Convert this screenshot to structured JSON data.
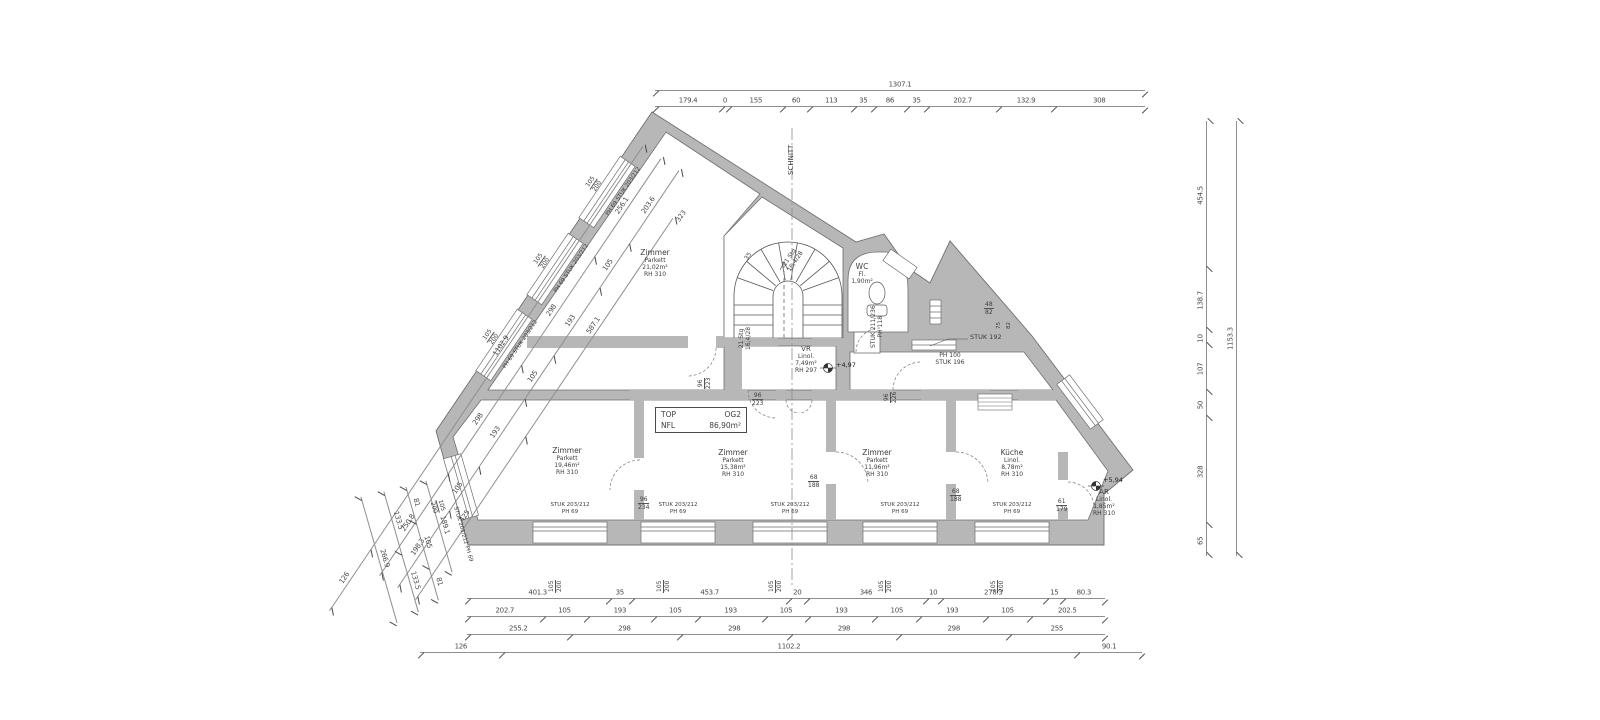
{
  "drawing": {
    "section_label": "SCHNITT",
    "title_box": {
      "l1a": "TOP",
      "l1b": "OG2",
      "l2a": "NFL",
      "l2b": "86,90m²"
    },
    "rooms": [
      {
        "id": "zimmer-top",
        "name": "Zimmer",
        "floor": "Parkett",
        "area": "21,02m²",
        "rh": "RH 310"
      },
      {
        "id": "zimmer-left",
        "name": "Zimmer",
        "floor": "Parkett",
        "area": "19,46m²",
        "rh": "RH 310"
      },
      {
        "id": "zimmer-mid",
        "name": "Zimmer",
        "floor": "Parkett",
        "area": "15,38m²",
        "rh": "RH 310"
      },
      {
        "id": "zimmer-right",
        "name": "Zimmer",
        "floor": "Parkett",
        "area": "11,96m²",
        "rh": "RH 310"
      },
      {
        "id": "kueche",
        "name": "Küche",
        "floor": "Linol.",
        "area": "8,78m²",
        "rh": "RH 310"
      },
      {
        "id": "wc",
        "name": "WC",
        "floor": "Fl.",
        "area": "1,90m²",
        "rh": ""
      },
      {
        "id": "vr",
        "name": "VR",
        "floor": "Linol.",
        "area": "7,49m²",
        "rh": "RH 297"
      },
      {
        "id": "ar",
        "name": "AR",
        "floor": "Linol.",
        "area": "1,85m²",
        "rh": "RH 310"
      }
    ],
    "stair": {
      "line1": "21 Stg",
      "line2": "16,4/28"
    },
    "elevations": {
      "vr": "+4,97",
      "ar": "+5,94"
    },
    "wall_labels": {
      "interior_dim": "323",
      "wall_dim": "35",
      "stuk192": "STUK 192",
      "ph100": "PH 100",
      "stuk196": "STUK 196",
      "wc_tag1": "STUK 211/236",
      "wc_tag2": "PH 118",
      "niche_a": "48",
      "niche_b": "82",
      "niche_c": "75",
      "niche_d": "82"
    },
    "window_tag": {
      "stuk": "STUK 203/212",
      "ph": "PH 69",
      "size_w": "105",
      "size_h": "200"
    },
    "door_tags": [
      {
        "w": "96",
        "h": "223"
      },
      {
        "w": "96",
        "h": "223"
      },
      {
        "w": "96",
        "h": "234"
      },
      {
        "w": "96",
        "h": "226"
      },
      {
        "w": "68",
        "h": "188"
      },
      {
        "w": "68",
        "h": "188"
      },
      {
        "w": "61",
        "h": "179"
      }
    ],
    "dims": {
      "top": {
        "total": [
          "1307.1"
        ],
        "row": [
          "179.4",
          "0",
          "155",
          "60",
          "113",
          "35",
          "86",
          "35",
          "202.7",
          "132.9",
          "308"
        ]
      },
      "right": {
        "inner": [
          "65",
          "328",
          "50",
          "107",
          "10",
          "138.7",
          "454.5"
        ],
        "outer": [
          "1153.3"
        ]
      },
      "bottom": {
        "r1": [
          "401.3",
          "35",
          "453.7",
          "20",
          "346",
          "10",
          "278.3",
          "15",
          "80.3"
        ],
        "r2": [
          "202.7",
          "105",
          "193",
          "105",
          "193",
          "105",
          "193",
          "105",
          "193",
          "105",
          "202.5"
        ],
        "r3": [
          "255.2",
          "298",
          "298",
          "298",
          "298",
          "255"
        ],
        "r4": [
          "126",
          "1102.2",
          "90.1"
        ]
      },
      "diag_upper": {
        "c1": [
          "126",
          "1102.9"
        ],
        "c2": [
          "250.8",
          "298",
          "298",
          "256.1"
        ],
        "c3": [
          "198.3",
          "105",
          "193",
          "105",
          "193",
          "105",
          "203.6"
        ],
        "c4": [
          "425",
          "587.1"
        ]
      },
      "diag_lower": {
        "c1": [
          "189.1"
        ],
        "c2": [
          "81",
          "105",
          "81"
        ],
        "c3": [
          "133.5",
          "133.5"
        ],
        "c4": [
          "266.9"
        ]
      }
    }
  }
}
